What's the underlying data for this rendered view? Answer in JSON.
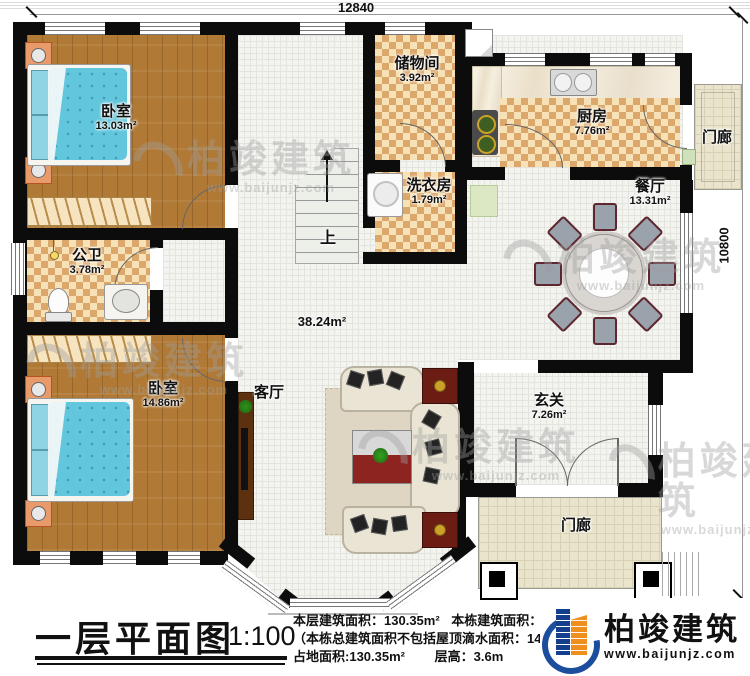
{
  "plan": {
    "dim_top": "12840",
    "dim_right": "10800",
    "hall_area": "38.24m²",
    "stairs_up": "上"
  },
  "rooms": {
    "bedroom1": {
      "name": "卧室",
      "area": "13.03m²"
    },
    "bedroom2": {
      "name": "卧室",
      "area": "14.86m²"
    },
    "bathroom": {
      "name": "公卫",
      "area": "3.78m²"
    },
    "storage": {
      "name": "储物间",
      "area": "3.92m²"
    },
    "laundry": {
      "name": "洗衣房",
      "area": "1.79m²"
    },
    "kitchen": {
      "name": "厨房",
      "area": "7.76m²"
    },
    "dining": {
      "name": "餐厅",
      "area": "13.31m²"
    },
    "living": {
      "name": "客厅"
    },
    "foyer": {
      "name": "玄关",
      "area": "7.26m²"
    },
    "porch_right": {
      "name": "门廊"
    },
    "porch_bottom": {
      "name": "门廊"
    }
  },
  "titleblock": {
    "title": "一层平面图",
    "scale": "1:100",
    "floor_area_label": "本层建筑面积：",
    "floor_area": "130.35m²",
    "total_area_label": "本栋建筑面积：",
    "total_area": "250.47m²",
    "note_label": "（本栋总建筑面积不包括屋顶滴水面积：",
    "note_value": "144.6m²",
    "land_area_label": "占地面积:",
    "land_area": "130.35m²",
    "height_label": "层高：",
    "height": "3.6m"
  },
  "brand": {
    "name": "柏竣建筑",
    "website": "www.baijunjz.com"
  },
  "watermark": {
    "name": "柏竣建筑",
    "website": "www.baijunjz.com"
  },
  "colors": {
    "wall": "#0c0c0c",
    "wood": "#b07a36",
    "checker": "#dca76b",
    "bed_blue": "#62c6dc",
    "logo_blue": "#1c4e9e",
    "logo_orange": "#ef8f1d"
  }
}
